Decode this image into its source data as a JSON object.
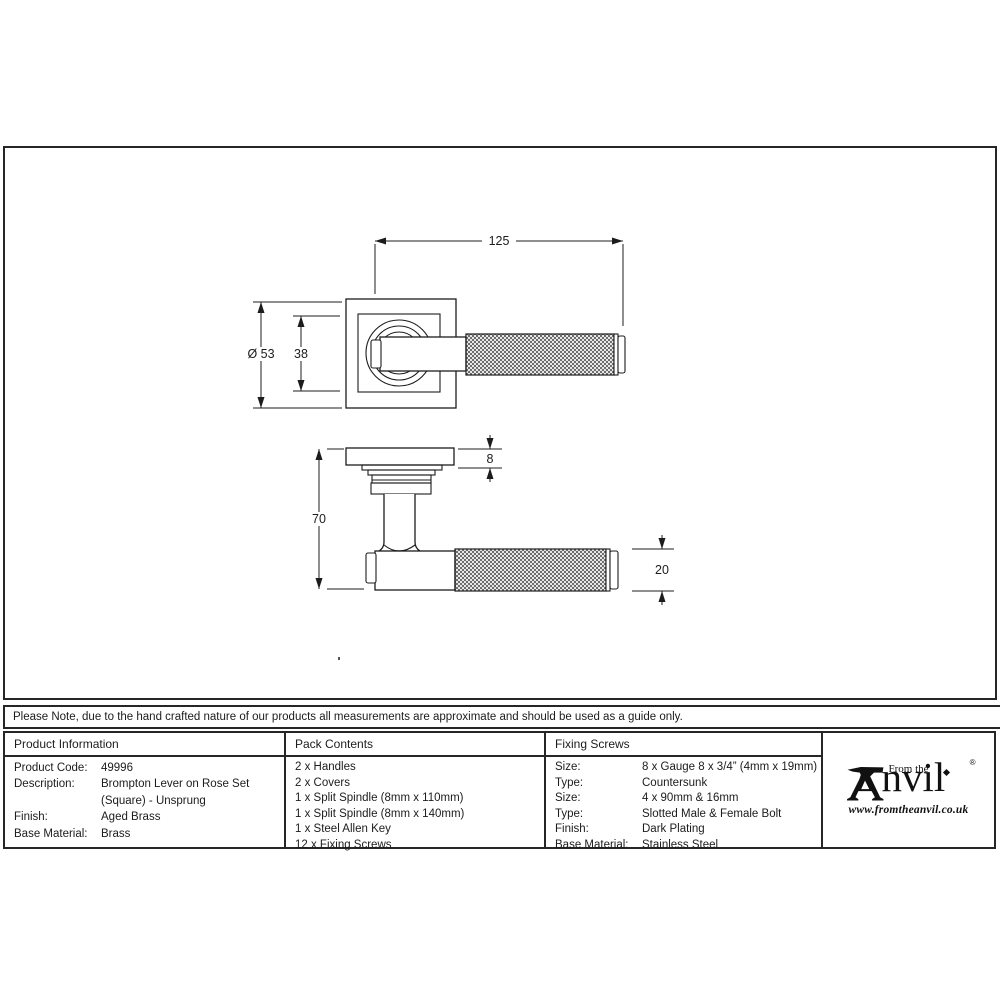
{
  "drawing": {
    "dim_overall_length": "125",
    "dim_rose_size": "Ø 53",
    "dim_inner_rose": "38",
    "dim_rose_thickness": "8",
    "dim_projection": "70",
    "dim_lever_diameter": "20"
  },
  "note": {
    "text": "Please Note, due to the hand crafted nature of our products all measurements are approximate and should be used as a guide only."
  },
  "table": {
    "product_information": {
      "header": "Product Information",
      "rows": [
        {
          "label": "Product Code:",
          "value": "49996"
        },
        {
          "label": "Description:",
          "value": "Brompton Lever on Rose Set (Square) - Unsprung"
        },
        {
          "label": "Finish:",
          "value": "Aged Brass"
        },
        {
          "label": "Base Material:",
          "value": "Brass"
        }
      ]
    },
    "pack_contents": {
      "header": "Pack Contents",
      "items": [
        "2 x Handles",
        "2 x Covers",
        "1 x Split Spindle (8mm x 110mm)",
        "1 x Split Spindle (8mm x 140mm)",
        "1 x Steel Allen Key",
        "12 x Fixing Screws"
      ]
    },
    "fixing_screws": {
      "header": "Fixing Screws",
      "rows": [
        {
          "label": "Size:",
          "value": "8 x Gauge 8 x 3/4” (4mm x 19mm)"
        },
        {
          "label": "Type:",
          "value": "Countersunk"
        },
        {
          "label": "Size:",
          "value": "4 x 90mm & 16mm"
        },
        {
          "label": "Type:",
          "value": "Slotted Male & Female Bolt"
        },
        {
          "label": "Finish:",
          "value": "Dark Plating"
        },
        {
          "label": "Base Material:",
          "value": "Stainless Steel"
        }
      ]
    }
  },
  "logo": {
    "prefix": "From the",
    "name_rest": "nvil",
    "registered": "®",
    "url": "www.fromtheanvil.co.uk"
  },
  "colors": {
    "line": "#1c1c1c",
    "background": "#ffffff"
  }
}
